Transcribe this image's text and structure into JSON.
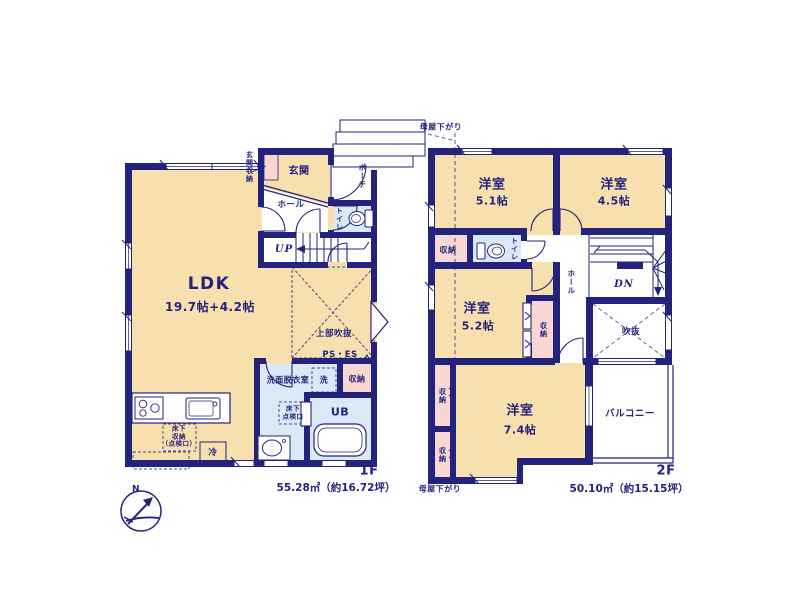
{
  "colors": {
    "wall": "#23237d",
    "room_fill": "#f8dfae",
    "wet_fill": "#d9e9f6",
    "closet_fill": "#f8d6d2",
    "text": "#23237d",
    "background": "#ffffff"
  },
  "floor1": {
    "floor_label": "1F",
    "area_label": "55.28㎡（約16.72坪）",
    "compass_north": "N",
    "labels": {
      "ldk": "LDK",
      "ldk_size": "19.7帖+4.2帖",
      "entrance": "玄関",
      "entrance_storage": "玄関収納",
      "porch": "ポーチ",
      "hall": "ホール",
      "toilet": "トイレ",
      "stairs_up": "UP",
      "upper_void": "上部吹抜",
      "pipe_space": "PS・ES",
      "washroom": "洗面脱衣室",
      "laundry": "洗",
      "storage": "収納",
      "unit_bath": "UB",
      "underfloor_hatch": "床下\n点検口",
      "underfloor_storage": "床下\n収納\n（点検口）",
      "refrigerator": "冷"
    }
  },
  "floor2": {
    "floor_label": "2F",
    "area_label": "50.10㎡（約15.15坪）",
    "labels": {
      "room_5_1": "洋室",
      "room_5_1_size": "5.1帖",
      "room_4_5": "洋室",
      "room_4_5_size": "4.5帖",
      "room_5_2": "洋室",
      "room_5_2_size": "5.2帖",
      "room_7_4": "洋室",
      "room_7_4_size": "7.4帖",
      "storage_nw": "収納",
      "toilet": "トイレ",
      "hall": "ホール",
      "stairs_down": "DN",
      "storage_mid": "収納",
      "void": "吹抜",
      "storage_w1": "収納",
      "storage_w2": "収納",
      "balcony": "バルコニー",
      "eaves_slope_top": "母屋下がり",
      "eaves_slope_bottom": "母屋下がり"
    }
  }
}
